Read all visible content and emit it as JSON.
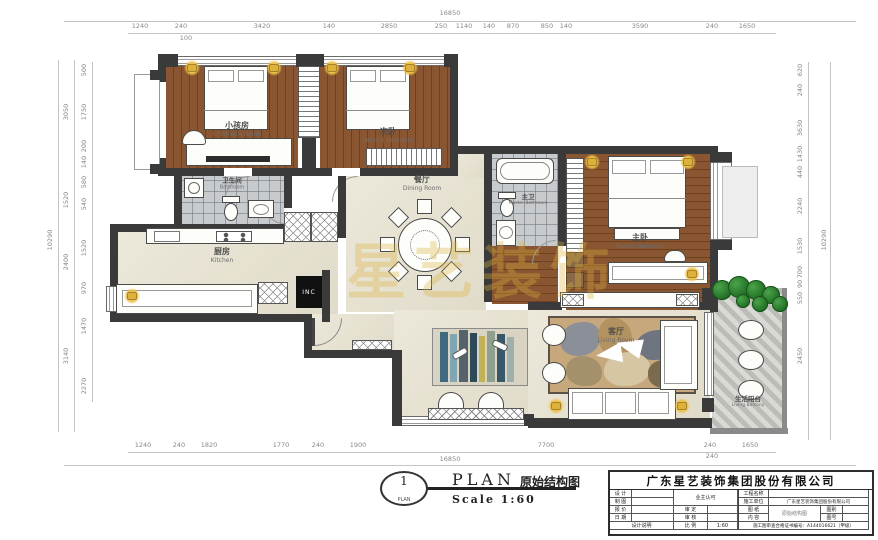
{
  "watermark": "星艺装饰",
  "plan_symbol": {
    "number": "1",
    "sub": "PLAN"
  },
  "plan_title": {
    "en": "PLAN",
    "cn": "原始结构图",
    "scale": "Scale 1:60"
  },
  "title_block": {
    "company": "广东星艺装饰集团股份有限公司",
    "labels": {
      "design": "设 计",
      "draft": "制 图",
      "quote": "报 价",
      "date": "日 期",
      "note": "设计说明",
      "owner": "业主认可",
      "approve": "审 定",
      "check": "审 核",
      "ratio": "比 例",
      "project": "工程名称",
      "builder": "施工单位",
      "sheet": "图 纸",
      "content": "内 容",
      "figtype": "图别",
      "figno": "图号"
    },
    "values": {
      "ratio": "1:60",
      "builder": "广东星艺装饰集团股份有限公司",
      "sheet": "原始结构图",
      "cert": "施工图审查合格证书编号：A144016621（甲级）"
    }
  },
  "rooms": {
    "children": {
      "cn": "小孩房",
      "en": "Children's Room"
    },
    "second": {
      "cn": "次卧",
      "en": "Second Bedroom"
    },
    "bath": {
      "cn": "卫生间",
      "en": "Bathroom"
    },
    "kitchen": {
      "cn": "厨房",
      "en": "Kitchen"
    },
    "dining": {
      "cn": "餐厅",
      "en": "Dining Room"
    },
    "masterbath": {
      "cn": "主卫",
      "en": "Master Bathroom"
    },
    "master": {
      "cn": "主卧",
      "en": "Master Bedroom"
    },
    "living": {
      "cn": "客厅",
      "en": "Living Room"
    },
    "balcony": {
      "cn": "生活阳台",
      "en": "Living Balcony"
    }
  },
  "appliances": {
    "fridge": "INC"
  },
  "dims": {
    "top": [
      {
        "t": "16850",
        "x": 450,
        "y": 13
      },
      {
        "t": "1240",
        "x": 140,
        "y": 26
      },
      {
        "t": "240",
        "x": 181,
        "y": 26
      },
      {
        "t": "3420",
        "x": 262,
        "y": 26
      },
      {
        "t": "140",
        "x": 329,
        "y": 26
      },
      {
        "t": "2850",
        "x": 389,
        "y": 26
      },
      {
        "t": "250",
        "x": 441,
        "y": 26
      },
      {
        "t": "1140",
        "x": 464,
        "y": 26
      },
      {
        "t": "140",
        "x": 489,
        "y": 26
      },
      {
        "t": "870",
        "x": 513,
        "y": 26
      },
      {
        "t": "850",
        "x": 547,
        "y": 26
      },
      {
        "t": "140",
        "x": 566,
        "y": 26
      },
      {
        "t": "3590",
        "x": 640,
        "y": 26
      },
      {
        "t": "240",
        "x": 712,
        "y": 26
      },
      {
        "t": "1650",
        "x": 747,
        "y": 26
      },
      {
        "t": "100",
        "x": 186,
        "y": 38
      }
    ],
    "bottom": [
      {
        "t": "1240",
        "x": 143,
        "y": 445
      },
      {
        "t": "240",
        "x": 179,
        "y": 445
      },
      {
        "t": "1820",
        "x": 209,
        "y": 445
      },
      {
        "t": "1770",
        "x": 281,
        "y": 445
      },
      {
        "t": "240",
        "x": 318,
        "y": 445
      },
      {
        "t": "1900",
        "x": 358,
        "y": 445
      },
      {
        "t": "7700",
        "x": 546,
        "y": 445
      },
      {
        "t": "240",
        "x": 710,
        "y": 445
      },
      {
        "t": "240",
        "x": 712,
        "y": 456
      },
      {
        "t": "1650",
        "x": 750,
        "y": 445
      },
      {
        "t": "16850",
        "x": 450,
        "y": 459
      }
    ],
    "left": [
      {
        "t": "10290",
        "x": 50,
        "y": 240,
        "v": 1
      },
      {
        "t": "3050",
        "x": 66,
        "y": 112,
        "v": 1
      },
      {
        "t": "1520",
        "x": 66,
        "y": 200,
        "v": 1
      },
      {
        "t": "2400",
        "x": 66,
        "y": 262,
        "v": 1
      },
      {
        "t": "3140",
        "x": 66,
        "y": 356,
        "v": 1
      },
      {
        "t": "500",
        "x": 84,
        "y": 70,
        "v": 1
      },
      {
        "t": "1750",
        "x": 84,
        "y": 112,
        "v": 1
      },
      {
        "t": "200",
        "x": 84,
        "y": 146,
        "v": 1
      },
      {
        "t": "140",
        "x": 84,
        "y": 162,
        "v": 1
      },
      {
        "t": "580",
        "x": 84,
        "y": 182,
        "v": 1
      },
      {
        "t": "540",
        "x": 84,
        "y": 204,
        "v": 1
      },
      {
        "t": "1520",
        "x": 84,
        "y": 248,
        "v": 1
      },
      {
        "t": "970",
        "x": 84,
        "y": 288,
        "v": 1
      },
      {
        "t": "1470",
        "x": 84,
        "y": 326,
        "v": 1
      },
      {
        "t": "2270",
        "x": 84,
        "y": 386,
        "v": 1
      }
    ],
    "right": [
      {
        "t": "10290",
        "x": 824,
        "y": 240,
        "v": 1
      },
      {
        "t": "620",
        "x": 800,
        "y": 70,
        "v": 1
      },
      {
        "t": "240",
        "x": 800,
        "y": 90,
        "v": 1
      },
      {
        "t": "3630",
        "x": 800,
        "y": 128,
        "v": 1
      },
      {
        "t": "1430",
        "x": 800,
        "y": 154,
        "v": 1
      },
      {
        "t": "440",
        "x": 800,
        "y": 172,
        "v": 1
      },
      {
        "t": "2240",
        "x": 800,
        "y": 206,
        "v": 1
      },
      {
        "t": "1530",
        "x": 800,
        "y": 246,
        "v": 1
      },
      {
        "t": "700",
        "x": 800,
        "y": 272,
        "v": 1
      },
      {
        "t": "90",
        "x": 800,
        "y": 284,
        "v": 1
      },
      {
        "t": "550",
        "x": 800,
        "y": 298,
        "v": 1
      },
      {
        "t": "2450",
        "x": 800,
        "y": 356,
        "v": 1
      }
    ]
  }
}
